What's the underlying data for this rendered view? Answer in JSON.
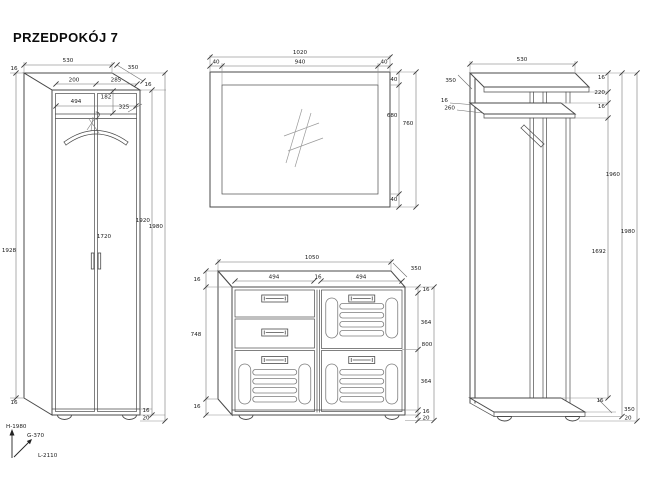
{
  "title": "PRZEDPOKÓJ 7",
  "legend": {
    "height_label": "H-1980",
    "depth_label": "G-370",
    "length_label": "L-2110"
  },
  "wardrobe": {
    "width_top": "530",
    "depth_top": "350",
    "side_thickness": "16",
    "left_door_width": "200",
    "right_door_width": "285",
    "top_panel_thickness": "16",
    "shelf_width": "494",
    "top_gap_height": "182",
    "shelf_depth": "325",
    "carcass_height": "1928",
    "door_height": "1720",
    "front_height": "1920",
    "total_height": "1980",
    "side_bottom_thickness": "16",
    "bottom_thickness": "16",
    "feet_height": "20"
  },
  "mirror": {
    "width_total": "1020",
    "frame_left": "40",
    "glass_width": "940",
    "frame_right": "40",
    "frame_top": "40",
    "glass_height": "680",
    "height_total": "760",
    "frame_bottom": "40"
  },
  "cabinet": {
    "width_top": "1050",
    "depth_top": "350",
    "left_door_width": "494",
    "divider_thickness": "16",
    "right_door_width": "494",
    "left_top_thickness": "16",
    "inner_height": "748",
    "left_bottom_thickness": "16",
    "right_top_thickness": "16",
    "upper_door_height": "364",
    "height_total": "800",
    "lower_door_height": "364",
    "right_bottom_thickness": "16",
    "feet_height": "20"
  },
  "rack": {
    "width_top": "530",
    "shelf_depth": "350",
    "lower_shelf_front_thickness": "16",
    "lower_shelf_depth": "260",
    "top_shelf_thickness": "16",
    "shelf_gap": "220",
    "lower_shelf_thickness": "16",
    "post_height": "1692",
    "body_height": "1960",
    "height_total": "1980",
    "base_thickness": "16",
    "base_depth": "350",
    "feet_height": "20"
  }
}
